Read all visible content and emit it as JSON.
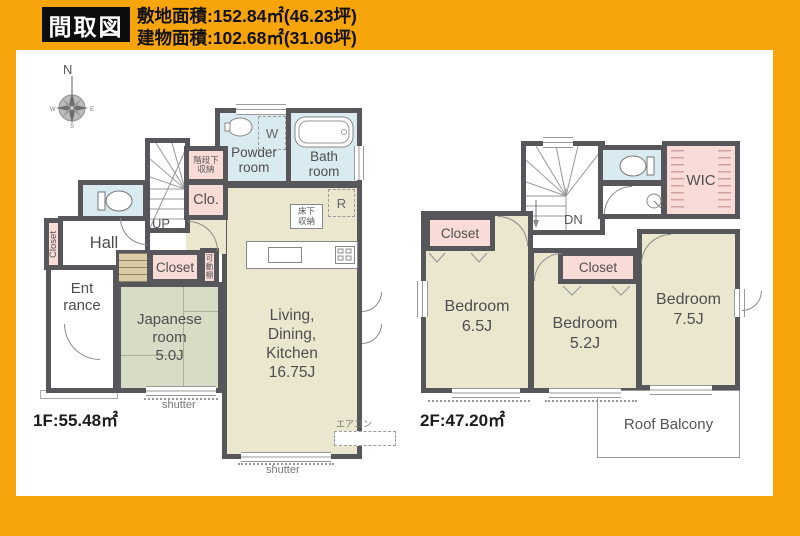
{
  "header": {
    "title": "間取図",
    "land_area": "敷地面積:152.84㎡(46.23坪)",
    "building_area": "建物面積:102.68㎡(31.06坪)"
  },
  "compass": {
    "n": "N",
    "e": "E",
    "s": "S",
    "w": "W"
  },
  "floor1": {
    "area_label": "1F:55.48㎡",
    "powder_room": [
      "Powder",
      "room"
    ],
    "bath_room": [
      "Bath",
      "room"
    ],
    "under_stairs": [
      "階段下",
      "収納"
    ],
    "clo": "Clo.",
    "hall": "Hall",
    "closet_hall": "Closet",
    "entrance": [
      "Ent",
      "rance"
    ],
    "closet_jp": "Closet",
    "movable_shelf": "可動棚",
    "japanese_room": [
      "Japanese",
      "room",
      "5.0J"
    ],
    "ldk": [
      "Living,",
      "Dining,",
      "Kitchen",
      "16.75J"
    ],
    "underfloor": [
      "床下",
      "収納"
    ],
    "fridge": "R",
    "washer": "W",
    "up": "UP",
    "aircon": "エアコン",
    "shutter_jp": "shutter",
    "shutter_ldk": "shutter"
  },
  "floor2": {
    "area_label": "2F:47.20㎡",
    "dn": "DN",
    "wic": "WIC",
    "closet_b1": "Closet",
    "closet_b2": "Closet",
    "bedroom1": [
      "Bedroom",
      "6.5J"
    ],
    "bedroom2": [
      "Bedroom",
      "5.2J"
    ],
    "bedroom3": [
      "Bedroom",
      "7.5J"
    ],
    "roof_balcony": "Roof Balcony"
  },
  "colors": {
    "accent_orange": "#F7A50A",
    "wall": "#57575B",
    "room_beige": "#EBE7CF",
    "room_blue": "#D9EAF1",
    "room_pink": "#F9DCD8",
    "room_green": "#D6DCC6"
  }
}
